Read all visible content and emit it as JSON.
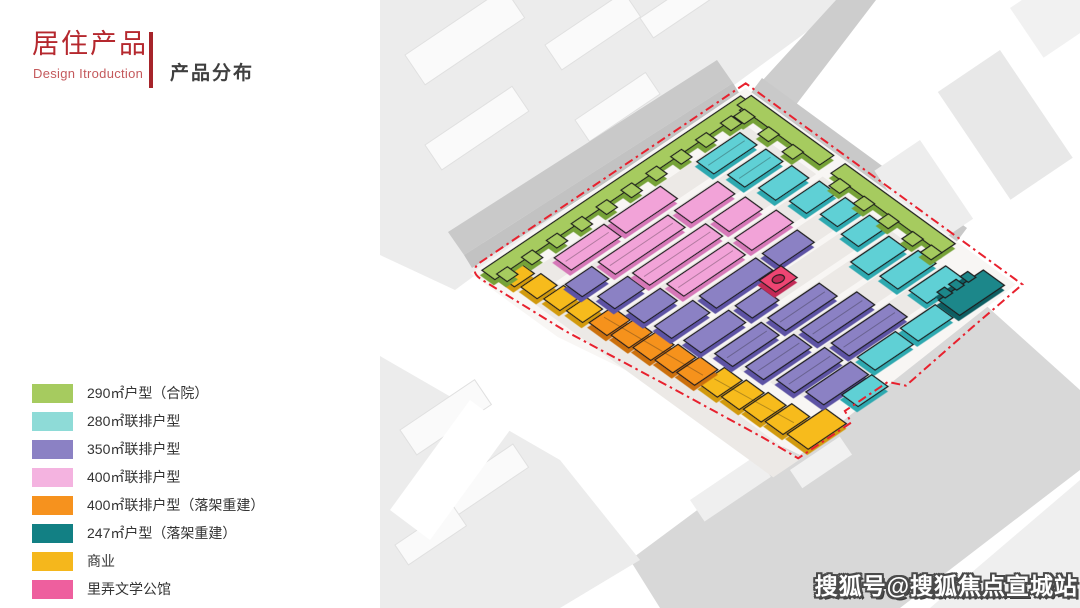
{
  "header": {
    "title": "居住产品",
    "subtitle": "Design Itroduction",
    "section": "产品分布",
    "accent_color": "#b5282e",
    "divider_color": "#a6242a"
  },
  "legend": {
    "items": [
      {
        "key": "green",
        "label": "290㎡户型（合院）",
        "color": "#a6cb5f"
      },
      {
        "key": "cyan",
        "label": "280㎡联排户型",
        "color": "#8edbd7"
      },
      {
        "key": "purple",
        "label": "350㎡联排户型",
        "color": "#8b81c4"
      },
      {
        "key": "pink",
        "label": "400㎡联排户型",
        "color": "#f4b3e0"
      },
      {
        "key": "orange",
        "label": "400㎡联排户型（落架重建）",
        "color": "#f6921e"
      },
      {
        "key": "teal",
        "label": "247㎡户型（落架重建）",
        "color": "#128084"
      },
      {
        "key": "yellow",
        "label": "商业",
        "color": "#f5b71c"
      },
      {
        "key": "magenta",
        "label": "里弄文学公馆",
        "color": "#ee5f9e"
      }
    ]
  },
  "map": {
    "palette": {
      "green": "#a6cb5f",
      "green_dark": "#76a238",
      "cyan": "#5fd0d5",
      "cyan_dark": "#2fa9b0",
      "purple": "#8b81c4",
      "purple_dark": "#5d53a4",
      "pink": "#f2a3d8",
      "pink_dark": "#d678b8",
      "orange": "#f6921e",
      "orange_dark": "#cc7008",
      "teal": "#1b878a",
      "teal_dark": "#0b5f63",
      "yellow": "#f7bb1c",
      "yellow_dark": "#d29a07",
      "magenta": "#ee4573",
      "magenta_dark": "#c22a57",
      "boundary": "#e8212e"
    }
  },
  "watermark": {
    "text": "搜狐号@搜狐焦点宣城站"
  }
}
